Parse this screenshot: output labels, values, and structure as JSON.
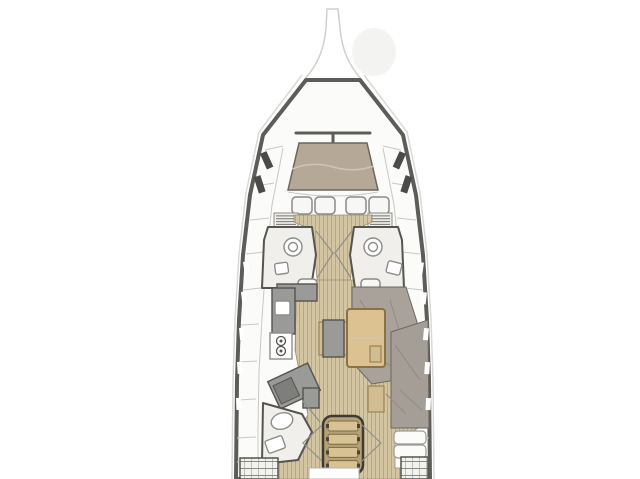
{
  "type": "sailboat-interior-floor-plan",
  "palette": {
    "background": "#ffffff",
    "hull_outline": "#5d5c58",
    "hull_halo": "#d9d9d5",
    "panel": "#fbfbfa",
    "panel_line": "#c8c8c4",
    "wall": "#55544e",
    "wood_base": "#d3c4a2",
    "wood_stripe": "#b7a77f",
    "bed_fwd": "#b5a897",
    "bed_aft": "#a49e96",
    "sofa": "#a8a29a",
    "upholstery_line": "#8d877f",
    "counter": "#9a9a98",
    "counter_dark": "#7e7e7c",
    "table_wood": "#dcc291",
    "table_edge": "#8a7245",
    "stair_wood": "#d6c292",
    "stair_base": "#b5a176",
    "stair_outline": "#3f3b33",
    "fixture": "#ffffff",
    "fixture_line": "#8d8d89",
    "window_dark": "#4a4a48",
    "door_line": "#8f8f8b",
    "head_floor": "#f0efeb"
  },
  "features": {
    "forward_hatch_count": 4,
    "stair_tread_count": 4,
    "stove_burner_count": 2,
    "louver_slat_count": 6,
    "hull_window_slot_count_per_side": 5,
    "aft_pillow_count": 2,
    "toilet_count": 3,
    "sink_count": 3
  }
}
